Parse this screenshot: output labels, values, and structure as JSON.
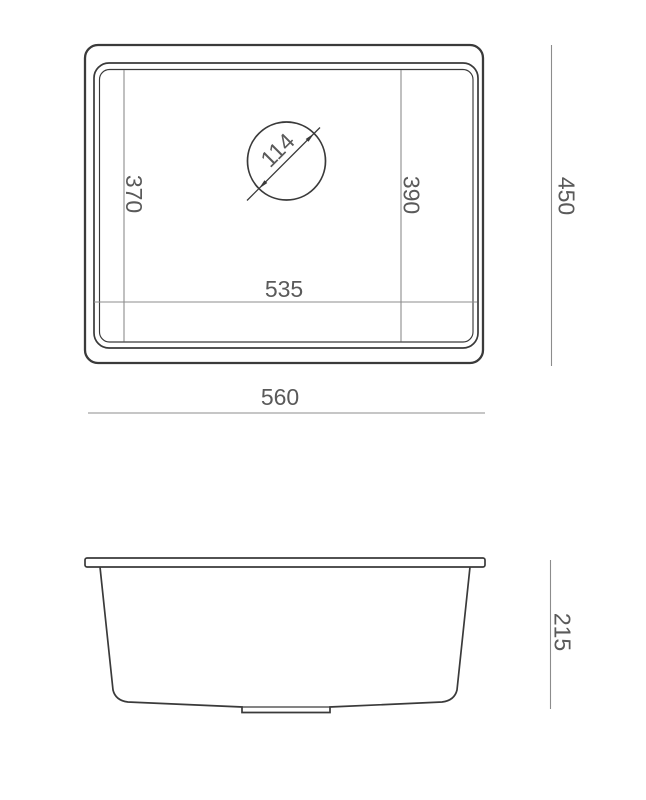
{
  "colors": {
    "background": "#ffffff",
    "outline": "#3a3a3a",
    "dimension_line": "#8c8c8c",
    "dimension_text": "#5a5a5a"
  },
  "top_view": {
    "bowl_depth_left": "370",
    "bowl_depth_right": "390",
    "bowl_width": "535",
    "drain_diameter": "114",
    "overall_depth": "450",
    "overall_width": "560"
  },
  "side_view": {
    "overall_height": "215"
  }
}
